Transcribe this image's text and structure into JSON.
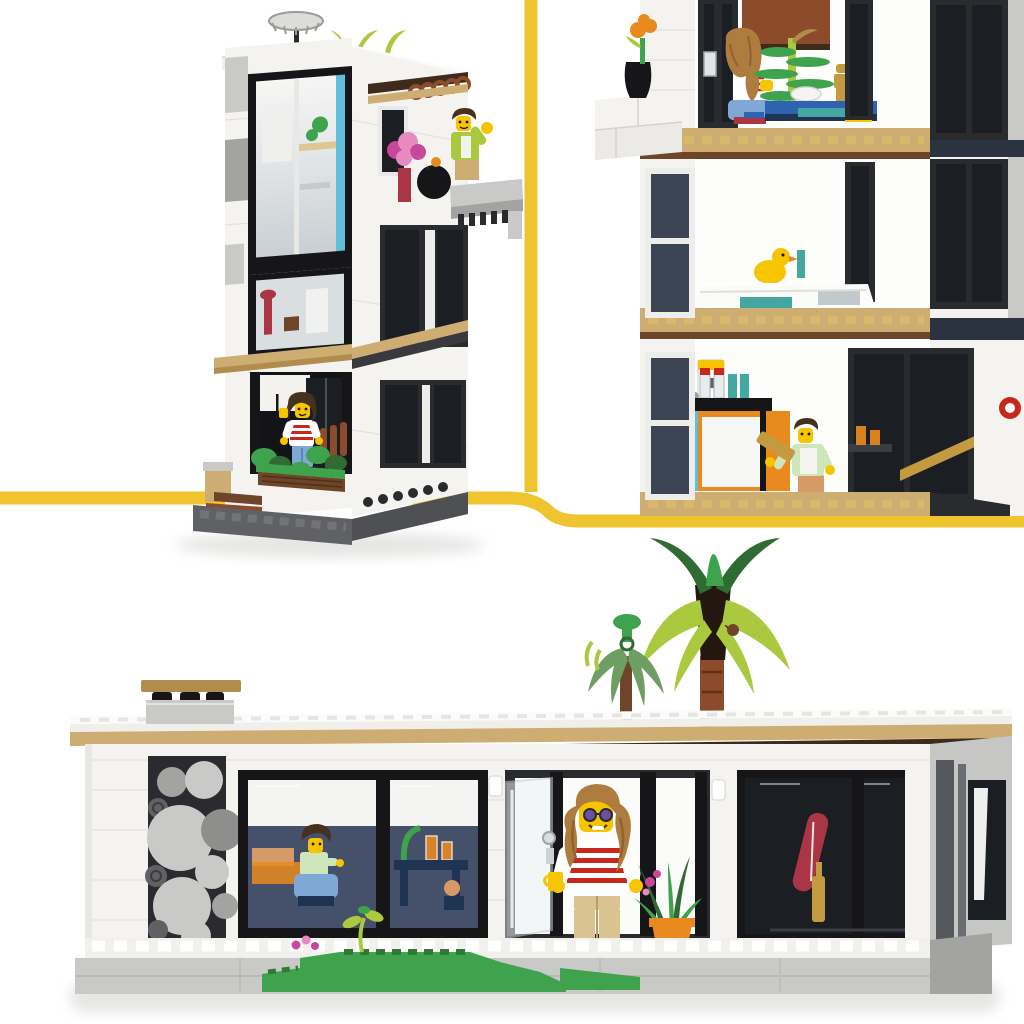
{
  "meta": {
    "kind": "product-photo",
    "subject": "LEGO Creator 3-in-1 modern house set shown in three builds",
    "canvas": {
      "width": 1024,
      "height": 1024,
      "background": "#FFFFFF"
    }
  },
  "scene": {
    "description": "LEGO modern house product photo: tall three-storey tower build top-left, interior close-up of three furnished floors top-right, wide single-storey bungalow build with rooftop palm tree at bottom; panels separated by yellow divider lines",
    "divider": {
      "style": "rounded stepped line",
      "vertical_x": 531,
      "left_y": 498,
      "right_y": 521,
      "thickness": 13
    },
    "panels": [
      {
        "id": "tower-build",
        "label": "three-storey tower house",
        "elements": [
          "chrome chandelier antenna on roof",
          "lime roof plants",
          "full-height front glazing with azure accent strip",
          "balcony with waving man minifigure in lime hoodie",
          "pink flower bouquet and black plant pot on balcony ledge",
          "tan canopy over ground-floor terrace",
          "woman minifigure in red-striped top standing on terrace with green bushes",
          "wooden steps and dark grey stud baseplate"
        ]
      },
      {
        "id": "interior-closeup",
        "label": "close-up of three furnished floors",
        "floors": [
          {
            "level": 3,
            "items": [
              "woman minifigure seated at blue desk",
              "green spiral plant sculpture",
              "white bowl",
              "gold minifigure trophy",
              "balcony ledge with black vase and orange flower"
            ]
          },
          {
            "level": 2,
            "items": [
              "yellow rubber duck",
              "white bathtub with teal tiles",
              "dark framed windows"
            ]
          },
          {
            "level": 1,
            "items": [
              "kitchen with coffee machine, jars and orange cabinet",
              "man minifigure carrying gold bar",
              "red wall clock",
              "amber drink glasses",
              "tan stud flooring"
            ]
          }
        ]
      },
      {
        "id": "bungalow-build",
        "label": "single-storey modern bungalow",
        "elements": [
          "flat white roof with tan fascia and rooftop table",
          "palm tree and small umbrella plant on roof",
          "decorative wall of grey circles",
          "left window: man minifigure seated at table with drinks and plants",
          "open doorway: standing woman minifigure with sunglasses, red-striped top and yellow cup",
          "agave plant in orange pot",
          "dark glazed wing with red surfboard and gold bottle",
          "white stud terrace, grey platform, green grass with pink flowers"
        ]
      }
    ],
    "minifigures": [
      {
        "id": "balcony-man",
        "look": "lime hoodie, dark brown hair, waving"
      },
      {
        "id": "terrace-woman",
        "look": "red-white striped top, medium blue legs, long brown hair"
      },
      {
        "id": "desk-woman",
        "look": "long tan hair, white top, seated on blue chair"
      },
      {
        "id": "kitchen-man",
        "look": "mint shirt with white apron, carrying gold bar"
      },
      {
        "id": "table-man",
        "look": "mint shirt, dark bushy hair, seated on blue chair"
      },
      {
        "id": "door-woman",
        "look": "sunglasses, white top with red stripes, tan legs, yellow cup"
      }
    ]
  },
  "palette": {
    "divider-yellow": "#F0C42F",
    "wall-white": "#F4F3F0",
    "roof-white": "#FBFBF9",
    "light-gray": "#C9C9C7",
    "mid-gray": "#A3A3A1",
    "dark-gray": "#5F6164",
    "charcoal": "#2A2B2E",
    "black": "#161618",
    "glass-dark": "#1B1E23",
    "glass-navy": "#3C4554",
    "interior-navy": "#45506A",
    "tan": "#DFC693",
    "sand": "#CDAD72",
    "dark-tan": "#B28B4F",
    "brown": "#6F452A",
    "red-brown": "#8C4B2B",
    "dark-brown": "#3E2B1C",
    "azure": "#5FBFDA",
    "teal": "#45A7A2",
    "blue": "#2E63B0",
    "navy": "#1F3453",
    "med-blue": "#7FA8D6",
    "lime": "#ABC93F",
    "green": "#3FA24C",
    "dark-green": "#2F6B33",
    "sage": "#6E9E62",
    "red": "#C8271E",
    "dark-red": "#A93545",
    "magenta": "#C9479B",
    "pink": "#E58BC0",
    "orange": "#E98A1F",
    "gold": "#C39A3F",
    "fig-yellow": "#F6C500",
    "nougat": "#D69A66",
    "hair-brown": "#46301E",
    "hair-tan": "#AE7C3E",
    "mint": "#CFE6BA",
    "shadow": "#D7D6D3"
  }
}
